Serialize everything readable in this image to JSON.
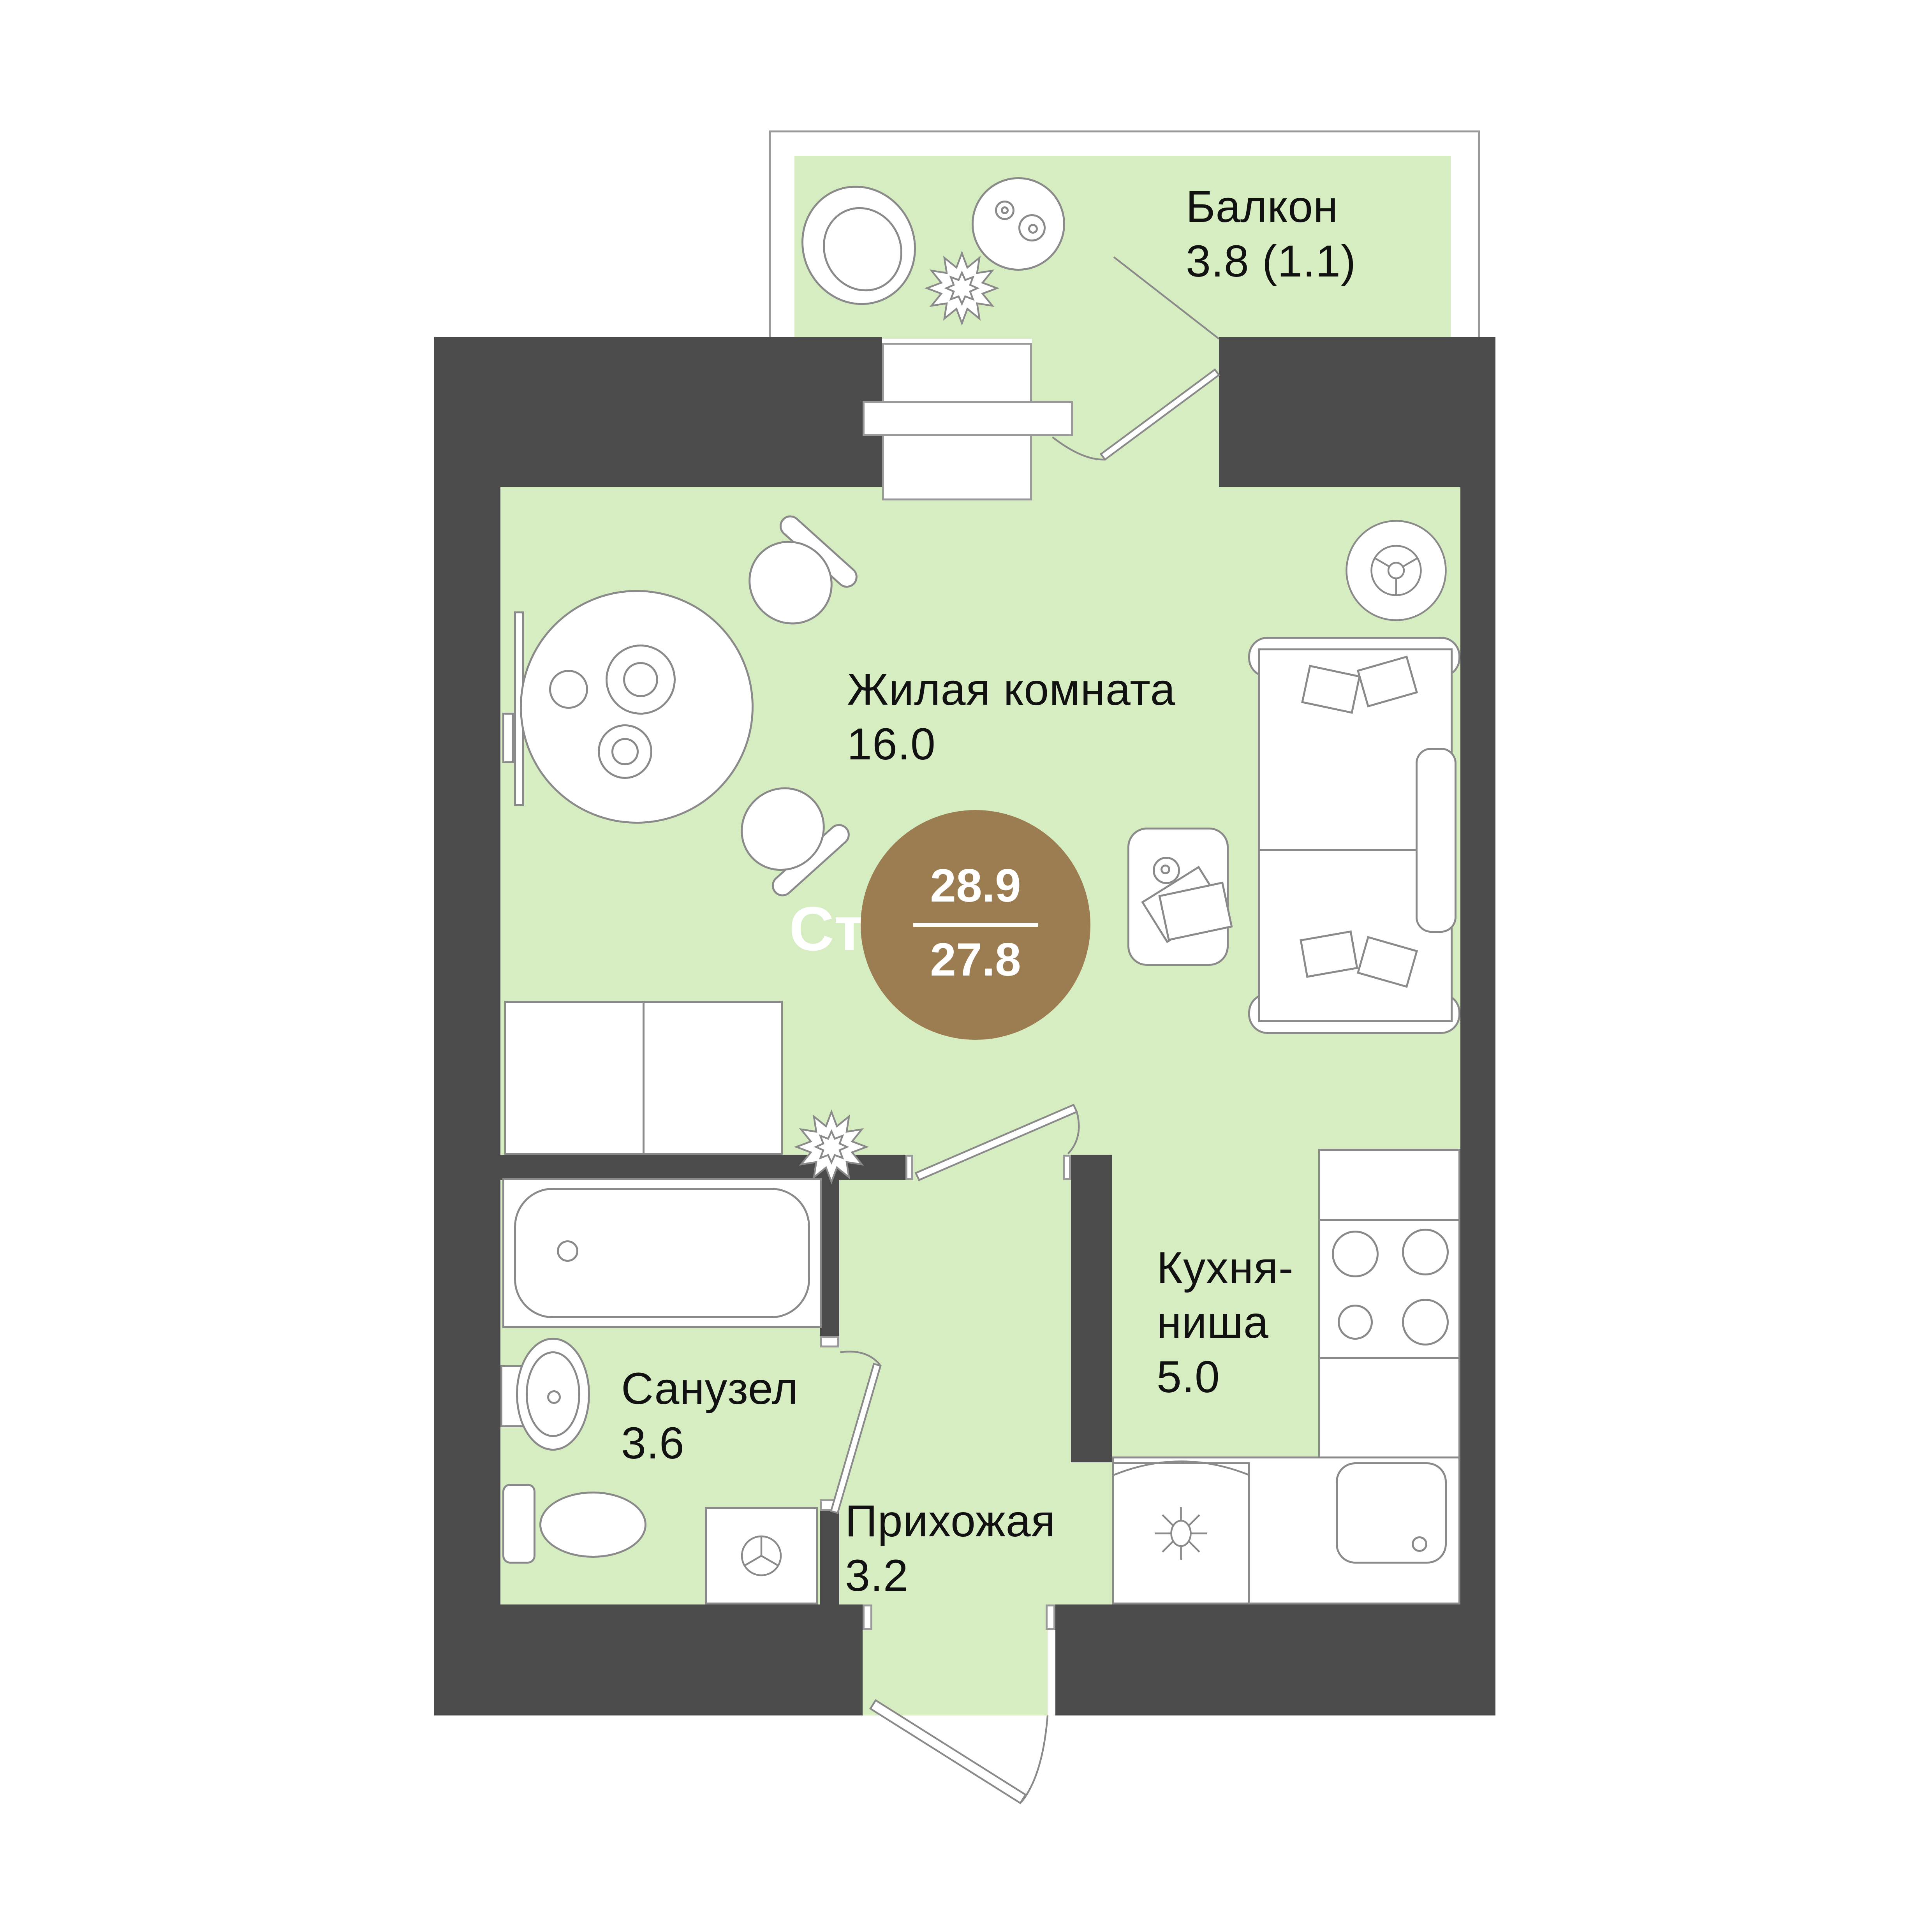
{
  "badge": {
    "type_label": "Ст",
    "total_area": "28.9",
    "living_area": "27.8"
  },
  "rooms": {
    "balcony": {
      "name": "Балкон",
      "area": "3.8 (1.1)"
    },
    "living": {
      "name": "Жилая комната",
      "area": "16.0"
    },
    "kitchen": {
      "name_line1": "Кухня-",
      "name_line2": "ниша",
      "area": "5.0"
    },
    "bathroom": {
      "name": "Санузел",
      "area": "3.6"
    },
    "hallway": {
      "name": "Прихожая",
      "area": "3.2"
    }
  },
  "colors": {
    "floor": "#d6ecc1",
    "wall": "#4b4b4b",
    "accent": "#9c7c51",
    "line": "#8a8a8a",
    "frame": "#9a9a9a",
    "text": "#111111",
    "bg": "#ffffff"
  }
}
